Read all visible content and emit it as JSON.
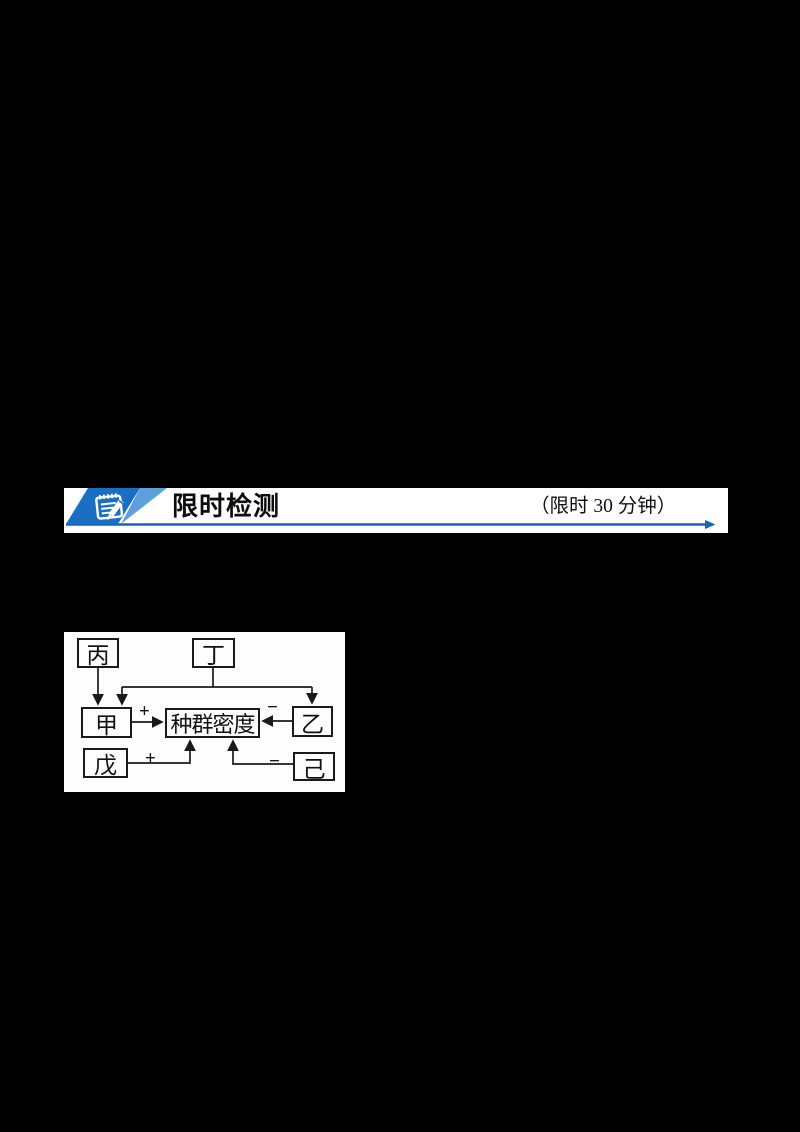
{
  "page": {
    "background": "#000000",
    "kind": "worksheet-page"
  },
  "banner": {
    "title": "限时检测",
    "time_limit": "（限时 30 分钟）",
    "icon": "notepad-pencil-icon",
    "icon_dark_blue": "#1b6fc3",
    "icon_light_blue": "#5b9fdb",
    "line_blue": "#1763b5"
  },
  "diagram": {
    "center_label": "种群密度",
    "nodes": {
      "bing": {
        "label": "丙"
      },
      "ding": {
        "label": "丁"
      },
      "jia": {
        "label": "甲"
      },
      "yi": {
        "label": "乙"
      },
      "wu": {
        "label": "戊"
      },
      "ji": {
        "label": "己"
      }
    },
    "signs": {
      "jia_plus": "+",
      "yi_minus": "−",
      "wu_plus": "+",
      "ji_minus": "−"
    },
    "edges": [
      {
        "from": "丙",
        "to": "甲",
        "sign": ""
      },
      {
        "from": "丁",
        "to": "甲",
        "sign": ""
      },
      {
        "from": "丁",
        "to": "乙",
        "sign": ""
      },
      {
        "from": "甲",
        "to": "种群密度",
        "sign": "+"
      },
      {
        "from": "乙",
        "to": "种群密度",
        "sign": "−"
      },
      {
        "from": "戊",
        "to": "种群密度",
        "sign": "+"
      },
      {
        "from": "己",
        "to": "种群密度",
        "sign": "−"
      }
    ]
  }
}
